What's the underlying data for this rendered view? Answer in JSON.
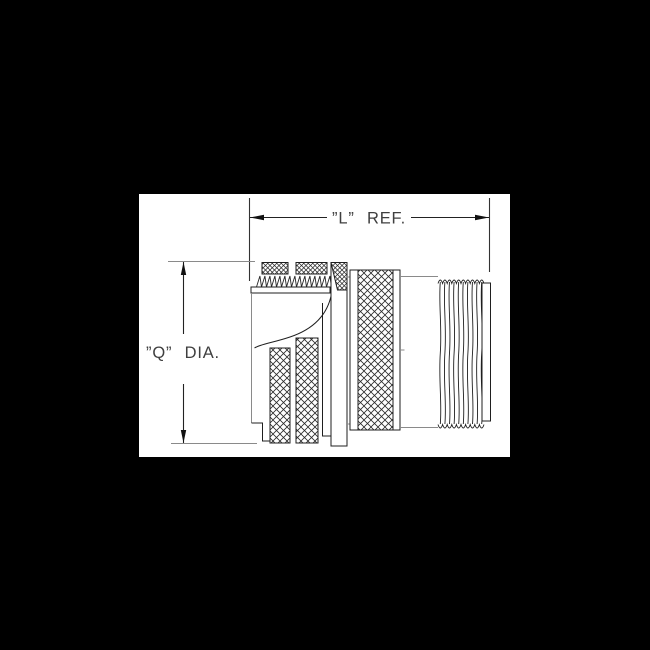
{
  "canvas": {
    "background_color": "#000000",
    "paper_color": "#ffffff"
  },
  "drawing": {
    "dimensions": {
      "length": {
        "label": "”L” REF."
      },
      "diameter": {
        "label": "”Q” DIA."
      }
    },
    "colors": {
      "line": "#1f1f1f",
      "light_line": "#8a8a8a",
      "hatch": "#2a2a2a",
      "text": "#3f3f3f"
    }
  }
}
